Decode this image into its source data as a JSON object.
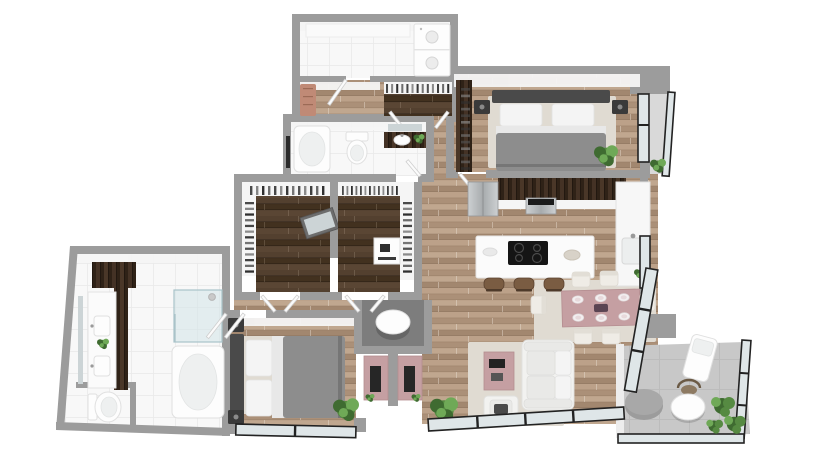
{
  "scene": {
    "type": "3d-floor-plan-render",
    "view": "top-down isometric",
    "canvas": {
      "width": 820,
      "height": 450
    },
    "text_visible": "none"
  },
  "palette": {
    "background": "#ffffff",
    "wall": "#9c9c9c",
    "wall_face": "#f5f5f5",
    "wood_1": "#bca189",
    "wood_2": "#ab9078",
    "wood_3": "#c0a78f",
    "wood_4": "#a2876f",
    "dark_floor_1": "#53402f",
    "dark_floor_2": "#42311f",
    "dark_floor_3": "#5a4634",
    "cabinet_1": "#443225",
    "cabinet_2": "#2f2217",
    "cabinet_3": "#4a3728",
    "tile": "#f8f8f8",
    "tile_line": "#e9e9e9",
    "concrete": "#c8c8c8",
    "concrete_line": "#bcbcbc",
    "rug": "#e0dbd2",
    "pink": "#c59fa2",
    "salmon": "#c08a76",
    "plant_dark": "#3f6b31",
    "plant_mid": "#568a42",
    "plant_light": "#6fa957",
    "duvet": "#8d8d8d",
    "headboard": "#4a4a4a",
    "pillow": "#f4f4f4",
    "sofa": "#f2f2f0",
    "sofa_shade": "#e9e9e7",
    "steel_light": "#cdd0d2",
    "steel_dark": "#a7abad",
    "frame": "#222222",
    "glass": "#dfe6e8",
    "fixture": "#fdfdfd",
    "fixture_line": "#e0e0e0",
    "mirror": "#ccd4d6",
    "tv": "#262626",
    "stool": "#7a5c42",
    "ottoman": "#9c9c9c"
  },
  "rooms": [
    {
      "name": "laundry-room",
      "floor": "tile",
      "furniture": [
        "stacked-washer-dryer",
        "cabinet-row"
      ]
    },
    {
      "name": "mudroom-entry",
      "floor": "wood",
      "furniture": [
        "salmon-bench",
        "coat-closet-hangers"
      ]
    },
    {
      "name": "bathroom-2",
      "floor": "tile",
      "furniture": [
        "bathtub",
        "toilet",
        "vanity-sink",
        "mirror",
        "towel-rail"
      ]
    },
    {
      "name": "walk-in-closet-left",
      "floor": "dark-wood",
      "furniture": [
        "hanging-rails",
        "tilted-mirror-dresser"
      ]
    },
    {
      "name": "walk-in-closet-right",
      "floor": "dark-wood",
      "furniture": [
        "hanging-rails",
        "dresser-with-accessories"
      ]
    },
    {
      "name": "bedroom-2",
      "floor": "wood",
      "furniture": [
        "double-bed",
        "two-nightstands",
        "wardrobe",
        "rug",
        "plant"
      ]
    },
    {
      "name": "kitchen",
      "floor": "wood",
      "furniture": [
        "fridge",
        "wall-cabinets",
        "stove",
        "island-with-cooktop",
        "three-bar-stools",
        "counter-sink",
        "counter-plant"
      ]
    },
    {
      "name": "dining-area",
      "floor": "wood",
      "furniture": [
        "pink-dining-table",
        "six-plates",
        "six-cream-chairs",
        "rug"
      ]
    },
    {
      "name": "living-area",
      "floor": "wood",
      "furniture": [
        "white-sofa",
        "pink-coffee-table",
        "armchair",
        "rug",
        "plant",
        "gray-ottoman"
      ]
    },
    {
      "name": "powder-niche",
      "floor": "dark",
      "furniture": [
        "round-pedestal",
        "two-pink-tv-consoles"
      ]
    },
    {
      "name": "master-bedroom",
      "floor": "wood",
      "furniture": [
        "double-bed",
        "two-nightstands",
        "rug",
        "plant",
        "window-band"
      ]
    },
    {
      "name": "master-bathroom",
      "floor": "tile",
      "furniture": [
        "double-vanity",
        "mirror",
        "shower",
        "bathtub",
        "toilet",
        "dark-cabinet",
        "plant"
      ]
    },
    {
      "name": "balcony",
      "floor": "concrete",
      "furniture": [
        "round-cafe-table",
        "cafe-chair",
        "lounge-chair",
        "shrubs",
        "glass-railing"
      ]
    }
  ]
}
